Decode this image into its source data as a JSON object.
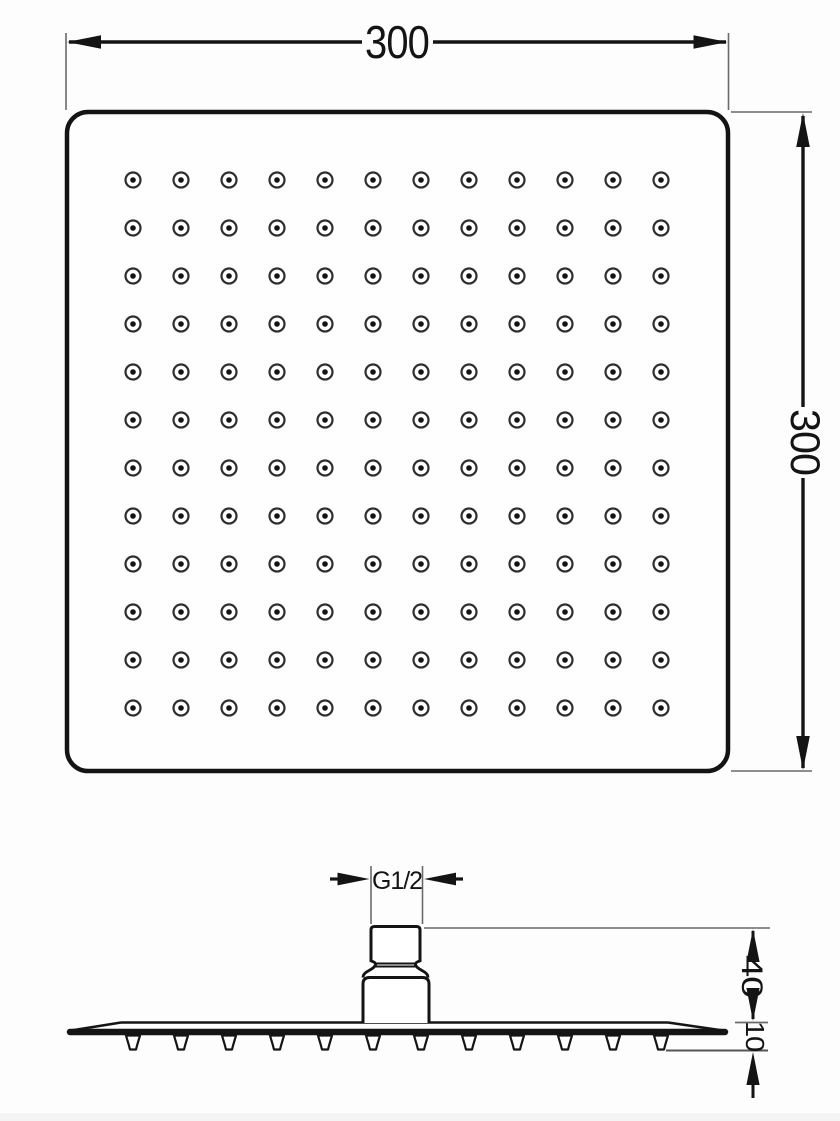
{
  "labels": {
    "top_width": "300",
    "side_height": "300",
    "thread": "G1/2",
    "connector_height": "40",
    "plate_thickness": "10"
  },
  "nozzle_grid": {
    "rows": 12,
    "cols": 12,
    "start_x": 133,
    "start_y": 180,
    "spacing": 48,
    "outer_radius": 7.5,
    "inner_radius": 2.8
  },
  "teeth": {
    "count": 12,
    "start_x": 133,
    "spacing": 48,
    "top_y": 1035.5,
    "height": 14,
    "half_top_width": 7,
    "half_bottom_width": 3
  },
  "colors": {
    "line": "#141414",
    "thin_line": "#6a6a6a",
    "ring": "#2e2e2e",
    "fill": "#ffffff"
  }
}
